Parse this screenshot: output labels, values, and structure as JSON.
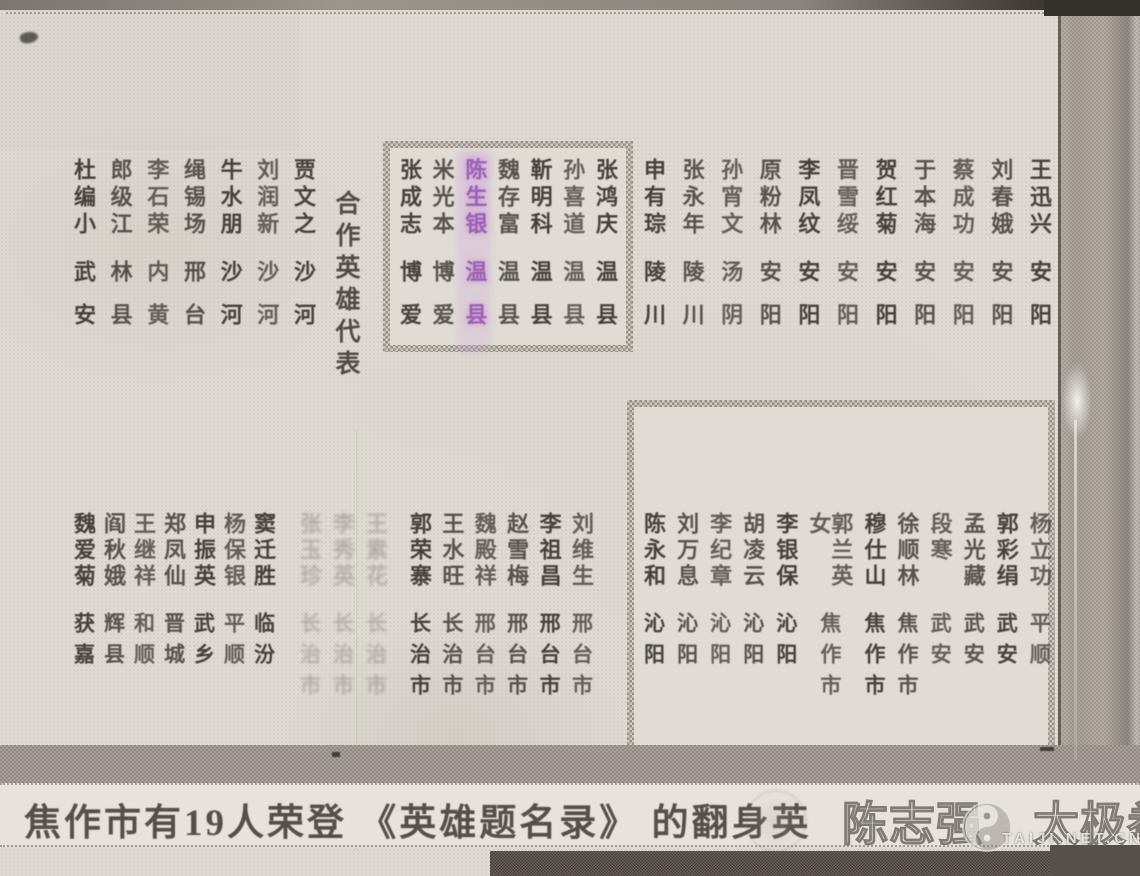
{
  "title": {
    "text": "合作英雄代表"
  },
  "caption": {
    "text": "焦作市有19人荣登 《英雄题名录》 的翻身英"
  },
  "watermark": {
    "name": "陈志强",
    "brand": "太极拳",
    "site": "TAIJI.NET.CN",
    "logo": "taiji-swirl-icon"
  },
  "colors": {
    "paper": "#e0dcd4",
    "ink": "#45403b",
    "highlight_purple": "#8b41aa",
    "box_border": "#a59e95",
    "dark_band": "#5e574f"
  },
  "top_section": {
    "left_columns": [
      {
        "name": "杜编小",
        "place": "武安"
      },
      {
        "name": "郎级江",
        "place": "林县"
      },
      {
        "name": "李石荣",
        "place": "内黄"
      },
      {
        "name": "绳锡场",
        "place": "邢台"
      },
      {
        "name": "牛水朋",
        "place": "沙河"
      },
      {
        "name": "刘润新",
        "place": "沙河"
      },
      {
        "name": "贾文之",
        "place": "沙河"
      }
    ],
    "box_columns": [
      {
        "name": "张成志",
        "place": "博爱"
      },
      {
        "name": "米光本",
        "place": "博爱"
      },
      {
        "name": "陈生银",
        "place": "温县",
        "highlight": true
      },
      {
        "name": "魏存富",
        "place": "温县"
      },
      {
        "name": "靳明科",
        "place": "温县"
      },
      {
        "name": "孙喜道",
        "place": "温县"
      },
      {
        "name": "张鸿庆",
        "place": "温县"
      }
    ],
    "right_columns": [
      {
        "name": "申有琮",
        "place": "陵川"
      },
      {
        "name": "张永年",
        "place": "陵川"
      },
      {
        "name": "孙宵文",
        "place": "汤阴"
      },
      {
        "name": "原粉林",
        "place": "安阳"
      },
      {
        "name": "李凤纹",
        "place": "安阳"
      },
      {
        "name": "晋雪绥",
        "place": "安阳"
      },
      {
        "name": "贺红菊",
        "place": "安阳"
      },
      {
        "name": "于本海",
        "place": "安阳"
      },
      {
        "name": "蔡成功",
        "place": "安阳"
      },
      {
        "name": "刘春娥",
        "place": "安阳"
      },
      {
        "name": "王迅兴",
        "place": "安阳"
      }
    ]
  },
  "bottom_section": {
    "left_columns": [
      {
        "name": "魏爱菊",
        "place": "获嘉"
      },
      {
        "name": "阎秋娥",
        "place": "辉县"
      },
      {
        "name": "王继祥",
        "place": "和顺"
      },
      {
        "name": "郑凤仙",
        "place": "晋城"
      },
      {
        "name": "申振英",
        "place": "武乡"
      },
      {
        "name": "杨保银",
        "place": "平顺"
      },
      {
        "name": "窦迁胜",
        "place": "临汾"
      }
    ],
    "middle_faded_columns": [
      {
        "name": "张玉珍",
        "place": "长治市",
        "faded": true
      },
      {
        "name": "李秀英",
        "place": "长治市",
        "faded": true
      },
      {
        "name": "王素花",
        "place": "长治市",
        "faded": true
      }
    ],
    "mid_right_columns": [
      {
        "name": "郭荣寨",
        "place": "长治市"
      },
      {
        "name": "王水旺",
        "place": "长治市"
      },
      {
        "name": "魏殿祥",
        "place": "邢台市"
      },
      {
        "name": "赵雪梅",
        "place": "邢台市"
      },
      {
        "name": "李祖昌",
        "place": "邢台市"
      },
      {
        "name": "刘维生",
        "place": "邢台市"
      }
    ],
    "box_columns": [
      {
        "name": "陈永和",
        "place": "沁阳"
      },
      {
        "name": "刘万息",
        "place": "沁阳"
      },
      {
        "name": "李纪章",
        "place": "沁阳"
      },
      {
        "name": "胡凌云",
        "place": "沁阳"
      },
      {
        "name": "李银保",
        "place": "沁阳"
      },
      {
        "name": "郭兰英女",
        "place": "焦作市"
      },
      {
        "name": "穆仕山",
        "place": "焦作市"
      },
      {
        "name": "徐顺林",
        "place": "焦作市"
      },
      {
        "name": "段寒",
        "place": "武安"
      },
      {
        "name": "孟光藏",
        "place": "武安"
      },
      {
        "name": "郭彩绢",
        "place": "武安"
      },
      {
        "name": "杨立功",
        "place": "平顺"
      }
    ]
  }
}
